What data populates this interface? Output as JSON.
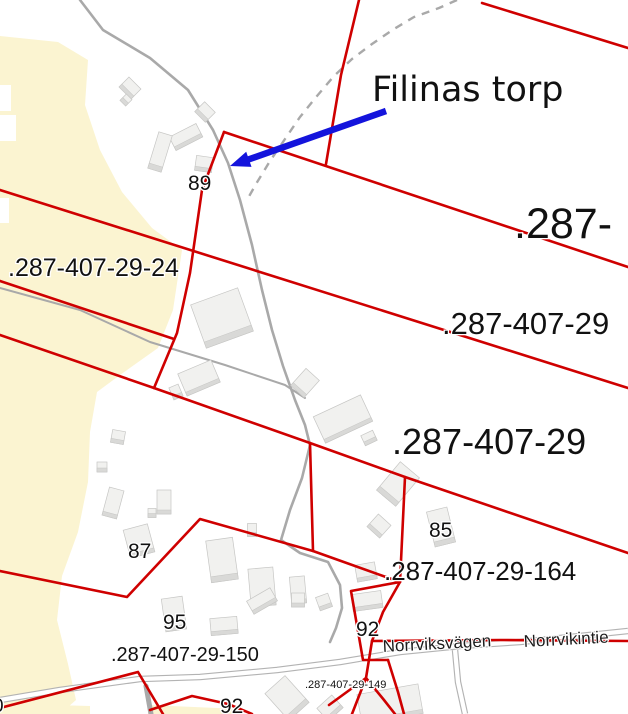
{
  "map": {
    "width": 628,
    "height": 714,
    "colors": {
      "background": "#ffffff",
      "boundary_red": "#cf0000",
      "road_gray": "#a9a9a9",
      "road_casing": "#b3b3b3",
      "field_yellow": "#fbf4d1",
      "building_fill": "#f1f1ef",
      "building_side": "#d9d9d7",
      "building_edge": "#c6c6c4",
      "arrow_blue": "#1414dc",
      "label_black": "#111111"
    },
    "annotation": {
      "text": "Filinas torp"
    },
    "arrow": {
      "x1": 386,
      "y1": 111,
      "x2": 230,
      "y2": 166
    },
    "labels": [
      {
        "t": "Filinas torp",
        "x": 372,
        "y": 101,
        "s": 35,
        "cls": "place"
      },
      {
        "t": ".287-",
        "x": 514,
        "y": 238,
        "s": 43,
        "cls": "lbl"
      },
      {
        "t": ".287-407-29",
        "x": 442,
        "y": 334,
        "s": 31,
        "cls": "lbl"
      },
      {
        "t": ".287-407-29",
        "x": 392,
        "y": 454,
        "s": 36,
        "cls": "lbl"
      },
      {
        "t": ".287-407-29-24",
        "x": 8,
        "y": 276,
        "s": 25,
        "cls": "lbl"
      },
      {
        "t": ".287-407-29-164",
        "x": 384,
        "y": 580,
        "s": 26,
        "cls": "lbl"
      },
      {
        "t": ".287-407-29-150",
        "x": 111,
        "y": 661,
        "s": 20,
        "cls": "lbl"
      },
      {
        "t": ".287-407-29-149",
        "x": 305,
        "y": 688,
        "s": 11,
        "cls": "lbl"
      },
      {
        "t": "89",
        "x": 188,
        "y": 190,
        "s": 21,
        "cls": "lbl"
      },
      {
        "t": "87",
        "x": 128,
        "y": 558,
        "s": 21,
        "cls": "lbl"
      },
      {
        "t": "95",
        "x": 163,
        "y": 629,
        "s": 21,
        "cls": "lbl"
      },
      {
        "t": "85",
        "x": 429,
        "y": 537,
        "s": 21,
        "cls": "lbl"
      },
      {
        "t": "92",
        "x": 356,
        "y": 636,
        "s": 21,
        "cls": "lbl"
      },
      {
        "t": "92",
        "x": 220,
        "y": 713,
        "s": 21,
        "cls": "lbl"
      },
      {
        "t": "0",
        "x": -7,
        "y": 712,
        "s": 19,
        "cls": "lbl"
      },
      {
        "t": "Norrviksvägen",
        "x": 383,
        "y": 652,
        "s": 17,
        "r": -3,
        "cls": "roadname"
      },
      {
        "t": "Norrvikintie",
        "x": 524,
        "y": 647,
        "s": 17,
        "r": -3,
        "cls": "roadname"
      }
    ],
    "fields": [
      [
        [
          0,
          36
        ],
        [
          58,
          42
        ],
        [
          88,
          60
        ],
        [
          85,
          105
        ],
        [
          100,
          150
        ],
        [
          122,
          192
        ],
        [
          152,
          228
        ],
        [
          182,
          250
        ],
        [
          173,
          310
        ],
        [
          158,
          348
        ],
        [
          120,
          375
        ],
        [
          97,
          392
        ],
        [
          90,
          432
        ],
        [
          88,
          482
        ],
        [
          78,
          532
        ],
        [
          62,
          576
        ],
        [
          57,
          620
        ],
        [
          68,
          664
        ],
        [
          76,
          700
        ],
        [
          60,
          714
        ],
        [
          0,
          714
        ]
      ],
      [
        [
          18,
          704
        ],
        [
          90,
          706
        ],
        [
          90,
          714
        ],
        [
          18,
          714
        ]
      ],
      [
        [
          148,
          705
        ],
        [
          240,
          709
        ],
        [
          240,
          714
        ],
        [
          148,
          714
        ]
      ]
    ],
    "field_holes": [
      {
        "x": 0,
        "y": 85,
        "w": 11,
        "h": 26
      },
      {
        "x": 0,
        "y": 115,
        "w": 16,
        "h": 26
      },
      {
        "x": 0,
        "y": 198,
        "w": 9,
        "h": 25
      }
    ],
    "roads_solid": [
      {
        "w": 2.6,
        "pts": [
          [
            80,
            0
          ],
          [
            103,
            30
          ],
          [
            150,
            58
          ],
          [
            188,
            90
          ],
          [
            213,
            130
          ],
          [
            228,
            163
          ],
          [
            240,
            200
          ],
          [
            252,
            245
          ],
          [
            262,
            290
          ],
          [
            272,
            330
          ],
          [
            283,
            366
          ],
          [
            295,
            400
          ],
          [
            305,
            425
          ],
          [
            310,
            445
          ],
          [
            302,
            478
          ],
          [
            290,
            510
          ],
          [
            281,
            540
          ],
          [
            300,
            553
          ],
          [
            328,
            562
          ],
          [
            340,
            585
          ],
          [
            342,
            608
          ],
          [
            336,
            628
          ],
          [
            330,
            642
          ]
        ]
      },
      {
        "w": 2.0,
        "pts": [
          [
            0,
            288
          ],
          [
            80,
            310
          ],
          [
            150,
            342
          ],
          [
            225,
            365
          ],
          [
            285,
            385
          ],
          [
            305,
            398
          ]
        ]
      },
      {
        "w": 5.0,
        "pts": [
          [
            146,
            686
          ],
          [
            151,
            714
          ]
        ]
      }
    ],
    "roads_cased": [
      [
        [
          0,
          700
        ],
        [
          60,
          690
        ],
        [
          140,
          679
        ],
        [
          200,
          677
        ],
        [
          277,
          670
        ],
        [
          340,
          662
        ],
        [
          400,
          652
        ],
        [
          460,
          646
        ],
        [
          520,
          642
        ],
        [
          580,
          636
        ],
        [
          628,
          631
        ]
      ],
      [
        [
          455,
          650
        ],
        [
          458,
          682
        ],
        [
          465,
          714
        ]
      ]
    ],
    "roads_dashed": [
      [
        [
          457,
          0
        ],
        [
          439,
          8
        ],
        [
          414,
          17
        ],
        [
          394,
          29
        ],
        [
          372,
          44
        ],
        [
          352,
          59
        ],
        [
          334,
          76
        ],
        [
          317,
          96
        ],
        [
          300,
          117
        ],
        [
          285,
          139
        ],
        [
          270,
          161
        ],
        [
          256,
          184
        ],
        [
          247,
          200
        ]
      ]
    ],
    "buildings": [
      [
        130,
        88,
        17,
        14,
        45
      ],
      [
        126,
        100,
        8,
        9,
        45
      ],
      [
        205,
        112,
        15,
        14,
        45
      ],
      [
        186,
        137,
        30,
        15,
        -27
      ],
      [
        160,
        152,
        14,
        38,
        17
      ],
      [
        204,
        164,
        17,
        15,
        8
      ],
      [
        222,
        318,
        50,
        46,
        -20
      ],
      [
        199,
        378,
        36,
        24,
        -23
      ],
      [
        176,
        392,
        10,
        13,
        -23
      ],
      [
        305,
        383,
        18,
        23,
        42
      ],
      [
        343,
        419,
        52,
        29,
        -25
      ],
      [
        369,
        438,
        13,
        11,
        -25
      ],
      [
        118,
        437,
        13,
        13,
        10
      ],
      [
        102,
        467,
        10,
        10,
        0
      ],
      [
        113,
        503,
        15,
        29,
        15
      ],
      [
        164,
        502,
        14,
        24,
        0
      ],
      [
        152,
        513,
        8,
        9,
        0
      ],
      [
        139,
        541,
        25,
        29,
        -15
      ],
      [
        252,
        530,
        9,
        13,
        0
      ],
      [
        222,
        560,
        27,
        42,
        -8
      ],
      [
        262,
        587,
        25,
        38,
        -5
      ],
      [
        298,
        590,
        15,
        27,
        -5
      ],
      [
        174,
        614,
        21,
        33,
        -8
      ],
      [
        224,
        626,
        27,
        17,
        -5
      ],
      [
        262,
        601,
        27,
        15,
        -30
      ],
      [
        298,
        600,
        13,
        14,
        0
      ],
      [
        324,
        602,
        13,
        14,
        -20
      ],
      [
        287,
        698,
        27,
        36,
        -42
      ],
      [
        330,
        708,
        20,
        17,
        -42
      ],
      [
        366,
        572,
        20,
        17,
        -10
      ],
      [
        367,
        601,
        30,
        17,
        -8
      ],
      [
        379,
        526,
        17,
        17,
        42
      ],
      [
        441,
        527,
        21,
        36,
        -14
      ],
      [
        398,
        484,
        25,
        37,
        40
      ],
      [
        390,
        704,
        62,
        30,
        -10
      ]
    ],
    "boundaries": [
      [
        [
          482,
          3
        ],
        [
          628,
          48
        ]
      ],
      [
        [
          359,
          0
        ],
        [
          341,
          75
        ],
        [
          326,
          164
        ]
      ],
      [
        [
          224,
          132
        ],
        [
          628,
          267
        ]
      ],
      [
        [
          224,
          132
        ],
        [
          202,
          190
        ],
        [
          190,
          273
        ],
        [
          177,
          333
        ],
        [
          154,
          388
        ]
      ],
      [
        [
          0,
          190
        ],
        [
          628,
          388
        ]
      ],
      [
        [
          0,
          281
        ],
        [
          174,
          339
        ]
      ],
      [
        [
          0,
          335
        ],
        [
          154,
          388
        ],
        [
          310,
          443
        ],
        [
          405,
          477
        ],
        [
          628,
          553
        ]
      ],
      [
        [
          310,
          443
        ],
        [
          313,
          551
        ]
      ],
      [
        [
          405,
          477
        ],
        [
          400,
          582
        ]
      ],
      [
        [
          0,
          571
        ],
        [
          127,
          597
        ],
        [
          200,
          519
        ],
        [
          313,
          551
        ],
        [
          400,
          582
        ]
      ],
      [
        [
          400,
          582
        ],
        [
          351,
          591
        ],
        [
          363,
          660
        ],
        [
          388,
          660
        ]
      ],
      [
        [
          400,
          582
        ],
        [
          383,
          612
        ],
        [
          372,
          641
        ],
        [
          366,
          678
        ],
        [
          352,
          714
        ]
      ],
      [
        [
          366,
          678
        ],
        [
          384,
          700
        ],
        [
          395,
          714
        ]
      ],
      [
        [
          388,
          660
        ],
        [
          398,
          692
        ],
        [
          404,
          714
        ]
      ],
      [
        [
          329,
          705
        ],
        [
          366,
          678
        ]
      ],
      [
        [
          372,
          641
        ],
        [
          500,
          640
        ],
        [
          628,
          641
        ]
      ],
      [
        [
          0,
          708
        ],
        [
          138,
          672
        ],
        [
          163,
          714
        ]
      ],
      [
        [
          150,
          710
        ],
        [
          192,
          696
        ],
        [
          228,
          704
        ],
        [
          252,
          714
        ]
      ]
    ]
  }
}
